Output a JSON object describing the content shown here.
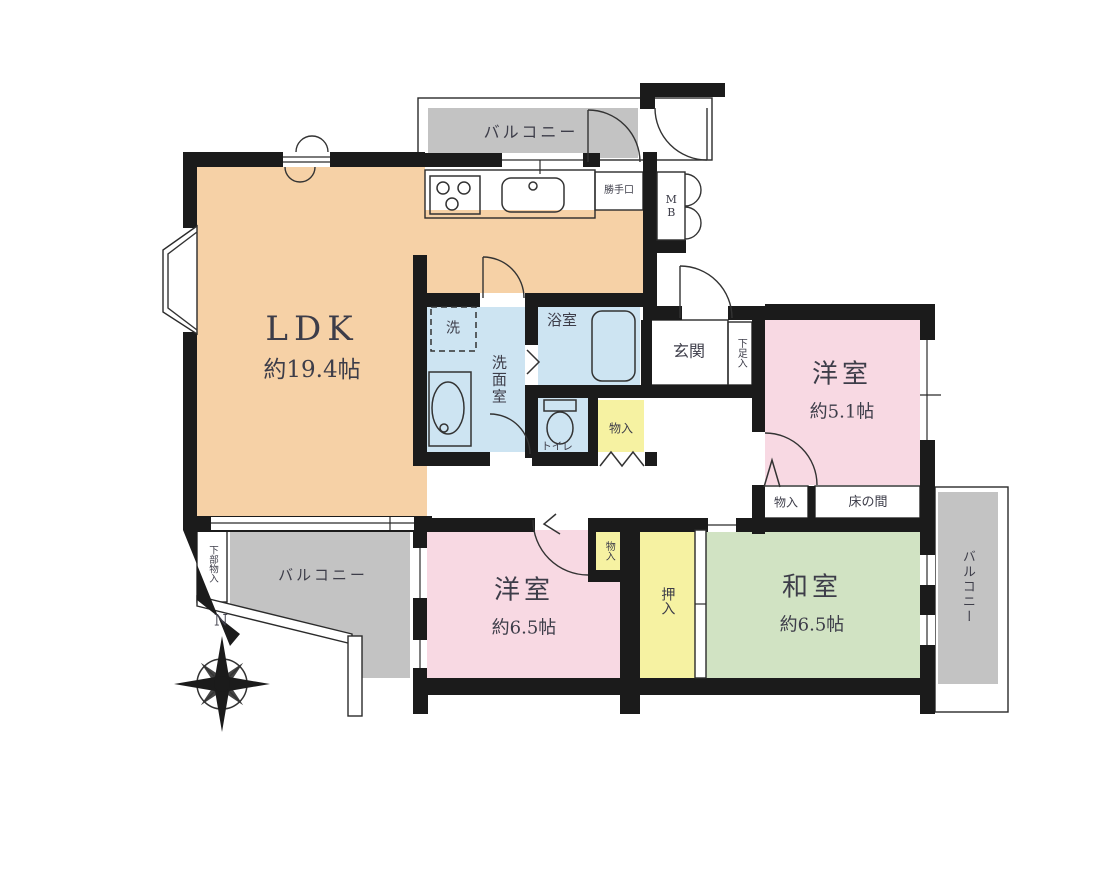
{
  "title": "apartment-floor-plan",
  "colors": {
    "ldk": "#f6d1a6",
    "western": "#f8d9e3",
    "japanese": "#d1e3c3",
    "storage": "#f6f2a2",
    "water": "#cde4f2",
    "balcony": "#c3c3c3",
    "entrance": "#c9c9c9",
    "tokonoma": "#b59a7d",
    "wall": "#1b1b1b",
    "text": "#3d3d49"
  },
  "rooms": {
    "ldk": {
      "label": "LDK",
      "size": "約19.4帖"
    },
    "western1": {
      "label": "洋室",
      "size": "約5.1帖"
    },
    "western2": {
      "label": "洋室",
      "size": "約6.5帖"
    },
    "japanese": {
      "label": "和室",
      "size": "約6.5帖"
    },
    "washroom": {
      "label": "洗面室"
    },
    "bath": {
      "label": "浴室"
    },
    "toilet": {
      "label": "トイレ"
    },
    "entrance": {
      "label": "玄関"
    }
  },
  "labels": {
    "balcony": "バルコニー",
    "storage": "物入",
    "closet": "押入",
    "shoe_storage": "下足入",
    "lower_storage": "下部物入",
    "tokonoma": "床の間",
    "laundry": "洗",
    "back_door": "勝手口",
    "meter_box": "MB",
    "north": "N"
  }
}
